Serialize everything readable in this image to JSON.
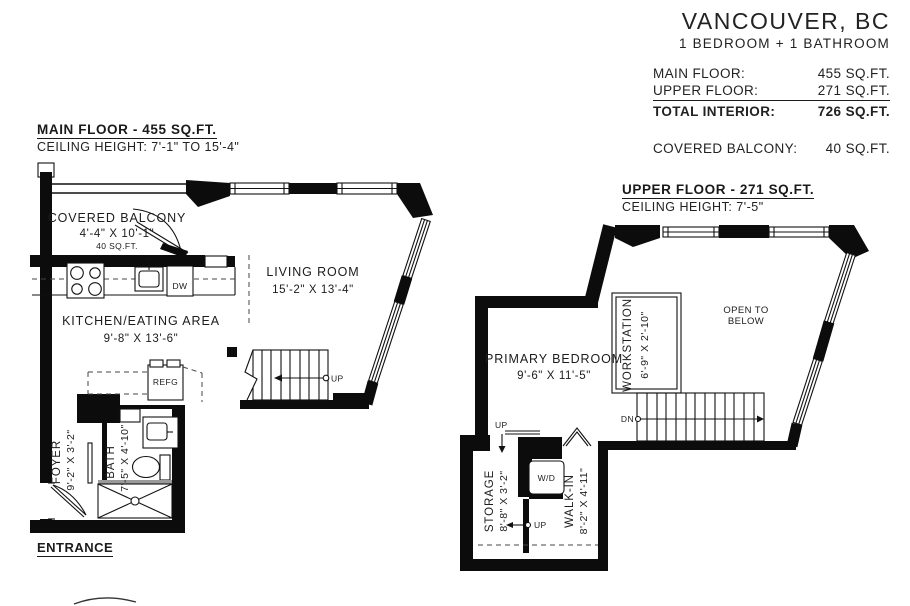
{
  "header": {
    "city": "VANCOUVER, BC",
    "unit_type": "1 BEDROOM + 1 BATHROOM",
    "areas": [
      {
        "label": "MAIN FLOOR:",
        "value": "455 SQ.FT."
      },
      {
        "label": "UPPER FLOOR:",
        "value": "271 SQ.FT."
      },
      {
        "label": "TOTAL INTERIOR:",
        "value": "726 SQ.FT."
      }
    ],
    "balcony_row": {
      "label": "COVERED BALCONY:",
      "value": "40 SQ.FT."
    }
  },
  "main_floor": {
    "title": "MAIN FLOOR - 455 SQ.FT.",
    "ceiling": "CEILING HEIGHT: 7'-1\" TO 15'-4\"",
    "entrance": "ENTRANCE",
    "rooms": {
      "balcony": {
        "name": "COVERED BALCONY",
        "dims": "4'-4\" X 10'-1\"",
        "area": "40 SQ.FT."
      },
      "living": {
        "name": "LIVING ROOM",
        "dims": "15'-2\" X 13'-4\""
      },
      "kitchen": {
        "name": "KITCHEN/EATING AREA",
        "dims": "9'-8\" X 13'-6\""
      },
      "foyer": {
        "name": "FOYER",
        "dims": "9'-2\" X 3'-2\""
      },
      "bath": {
        "name": "BATH",
        "dims": "7'-5\" X 4'-10\""
      }
    },
    "labels": {
      "dw": "DW",
      "refg": "REFG",
      "up": "UP"
    }
  },
  "upper_floor": {
    "title": "UPPER FLOOR - 271 SQ.FT.",
    "ceiling": "CEILING HEIGHT: 7'-5\"",
    "rooms": {
      "bedroom": {
        "name": "PRIMARY BEDROOM",
        "dims": "9'-6\" X 11'-5\""
      },
      "workstation": {
        "name": "WORKSTATION",
        "dims": "6'-9\" X 2'-10\""
      },
      "open_below": {
        "line1": "OPEN TO",
        "line2": "BELOW"
      },
      "storage": {
        "name": "STORAGE",
        "dims": "8'-8\" X 3'-2\""
      },
      "walkin": {
        "name": "WALK-IN",
        "dims": "8'-2\" X 4'-11\""
      }
    },
    "labels": {
      "wd": "W/D",
      "dn": "DN",
      "up": "UP"
    }
  }
}
